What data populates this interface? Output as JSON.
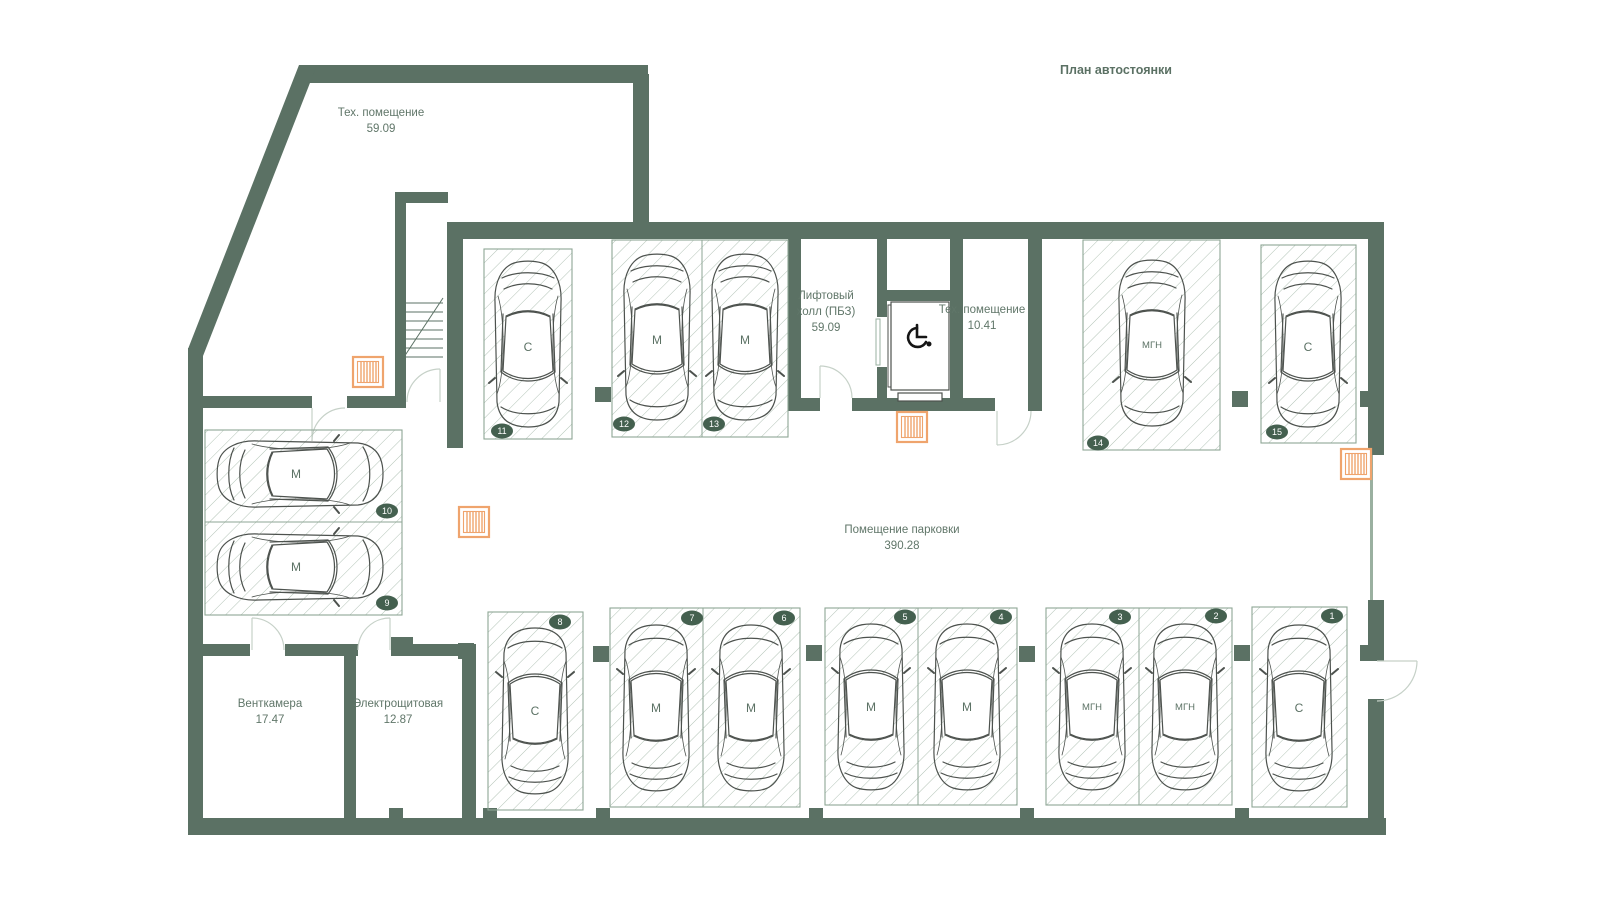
{
  "title": "План автостоянки",
  "rooms": {
    "tech_upper": {
      "name": "Тех. помещение",
      "area": "59.09"
    },
    "lift_hall": {
      "name_line1": "Лифтовый",
      "name_line2": "холл (ПБЗ)",
      "area": "59.09"
    },
    "tech_small": {
      "name": "Тех. помещение",
      "area": "10.41"
    },
    "parking_hall": {
      "name": "Помещение парковки",
      "area": "390.28"
    },
    "vent_chamber": {
      "name": "Венткамера",
      "area": "17.47"
    },
    "electrical": {
      "name": "Электрощитовая",
      "area": "12.87"
    }
  },
  "spots": [
    {
      "number": "1",
      "type": "С"
    },
    {
      "number": "2",
      "type": "МГН"
    },
    {
      "number": "3",
      "type": "МГН"
    },
    {
      "number": "4",
      "type": "М"
    },
    {
      "number": "5",
      "type": "М"
    },
    {
      "number": "6",
      "type": "М"
    },
    {
      "number": "7",
      "type": "М"
    },
    {
      "number": "8",
      "type": "С"
    },
    {
      "number": "9",
      "type": "М"
    },
    {
      "number": "10",
      "type": "М"
    },
    {
      "number": "11",
      "type": "С"
    },
    {
      "number": "12",
      "type": "М"
    },
    {
      "number": "13",
      "type": "М"
    },
    {
      "number": "14",
      "type": "МГН"
    },
    {
      "number": "15",
      "type": "С"
    }
  ],
  "icons": {
    "wheelchair_icon": "wheelchair-accessibility-symbol",
    "vent_grille_icon": "slatted-ventilation-grille",
    "stairs_icon": "staircase-treads"
  },
  "colors": {
    "wall": "#5b7164",
    "hatch": "#a9bcae",
    "spot_border": "#8ea695",
    "badge": "#44604f",
    "text": "#607669",
    "vent_orange": "#efa46d",
    "car_outline": "#4d524e",
    "door_arc": "#c6d1c8",
    "background": "#ffffff"
  }
}
